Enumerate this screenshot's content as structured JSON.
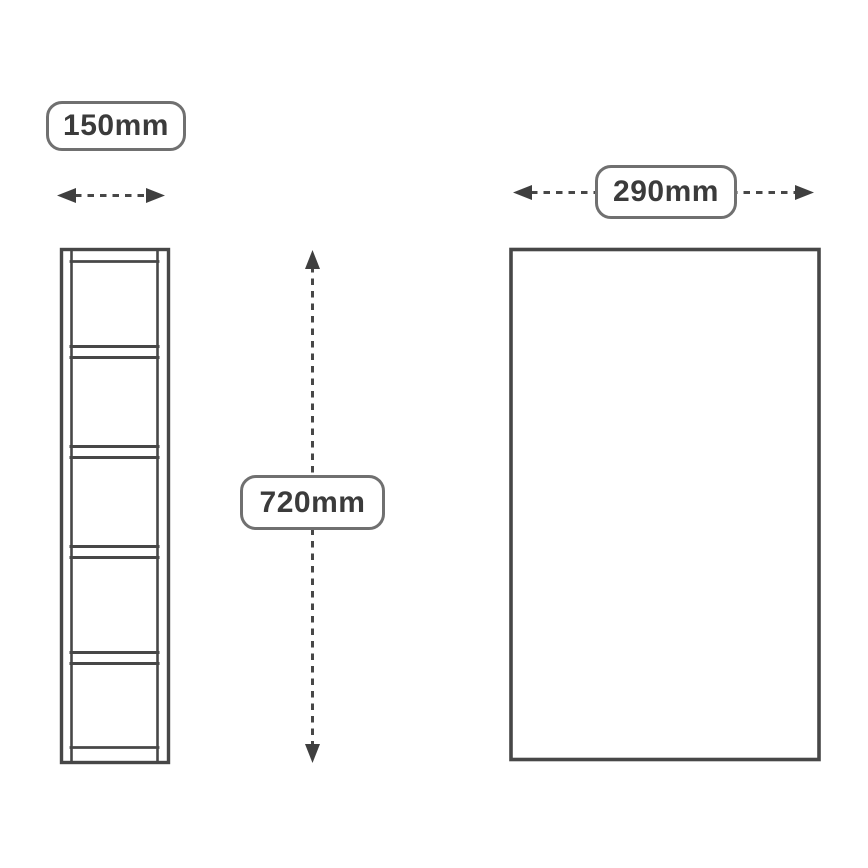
{
  "diagram": {
    "labels": {
      "side_width": "150mm",
      "height": "720mm",
      "front_width": "290mm"
    },
    "side_view": {
      "shelf_count": 4,
      "compartment_count": 5
    },
    "colors": {
      "background": "#ffffff",
      "line": "#474747",
      "label_border": "#707070",
      "label_text": "#3b3b3b"
    },
    "icons": {
      "side_width_arrow": "horizontal-double-headed-dashed-arrow",
      "height_arrow": "vertical-double-headed-dashed-arrow",
      "front_width_arrow": "horizontal-double-headed-dashed-arrow"
    }
  }
}
